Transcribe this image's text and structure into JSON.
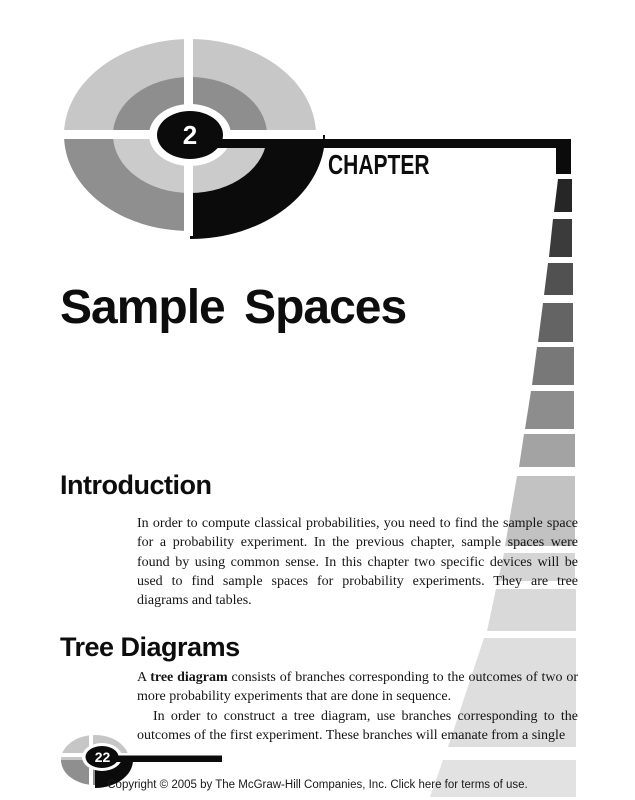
{
  "header": {
    "chapter_label": "CHAPTER",
    "chapter_number": "2"
  },
  "title": "Sample Spaces",
  "sections": {
    "intro": {
      "heading": "Introduction",
      "body": "In order to compute classical probabilities, you need to find the sample space for a probability experiment. In the previous chapter, sample spaces were found by using common sense. In this chapter two specific devices will be used to find sample spaces for probability experiments. They are tree diagrams and tables."
    },
    "tree": {
      "heading": "Tree Diagrams",
      "p1_prefix": "A ",
      "p1_bold": "tree diagram",
      "p1_rest": " consists of branches corresponding to the outcomes of two or more probability experiments that are done in sequence.",
      "p2": "In order to construct a tree diagram, use branches corresponding to the outcomes of the first experiment. These branches will emanate from a single"
    }
  },
  "footer": {
    "page_number": "22",
    "copyright_text": "Copyright © 2005 by The McGraw-Hill Companies, Inc. ",
    "terms_link": "Click here for terms of use."
  },
  "palette": {
    "ink": "#0d0d0d",
    "gray_light": "#c7c7c7",
    "gray_medium": "#8e8e8e",
    "ring_light": "#cbcbcb",
    "stair_darkest": "#262626",
    "stair_lightest": "#e2e2e2"
  }
}
